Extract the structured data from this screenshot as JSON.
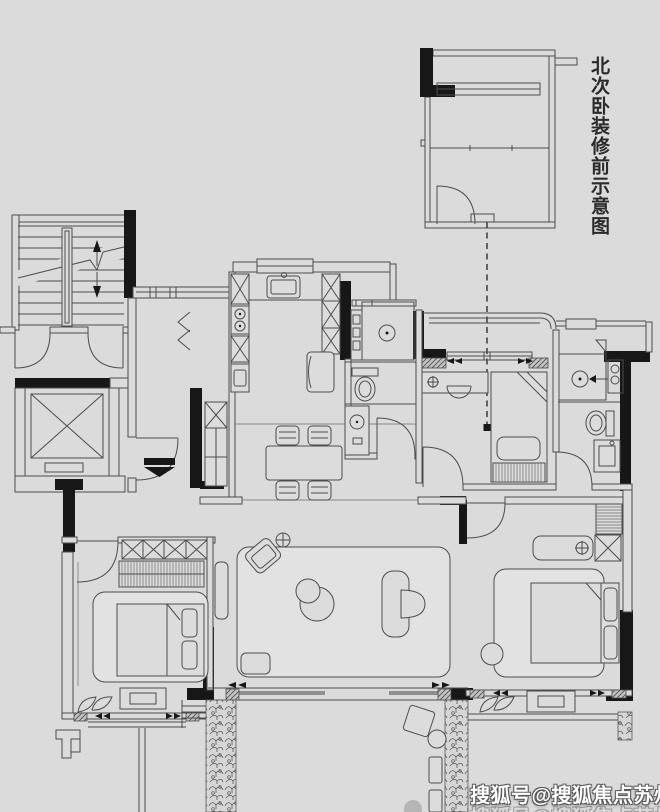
{
  "page": {
    "background_color": "#dbdbdb",
    "line_color": "#4d4d4d",
    "structure_color": "#171717"
  },
  "inset": {
    "label": "北次卧装修前示意图"
  },
  "watermark": {
    "text": "搜狐号@搜狐焦点苏州站",
    "text_color": "#ffffff",
    "outline_color": "#5a5a5a"
  }
}
